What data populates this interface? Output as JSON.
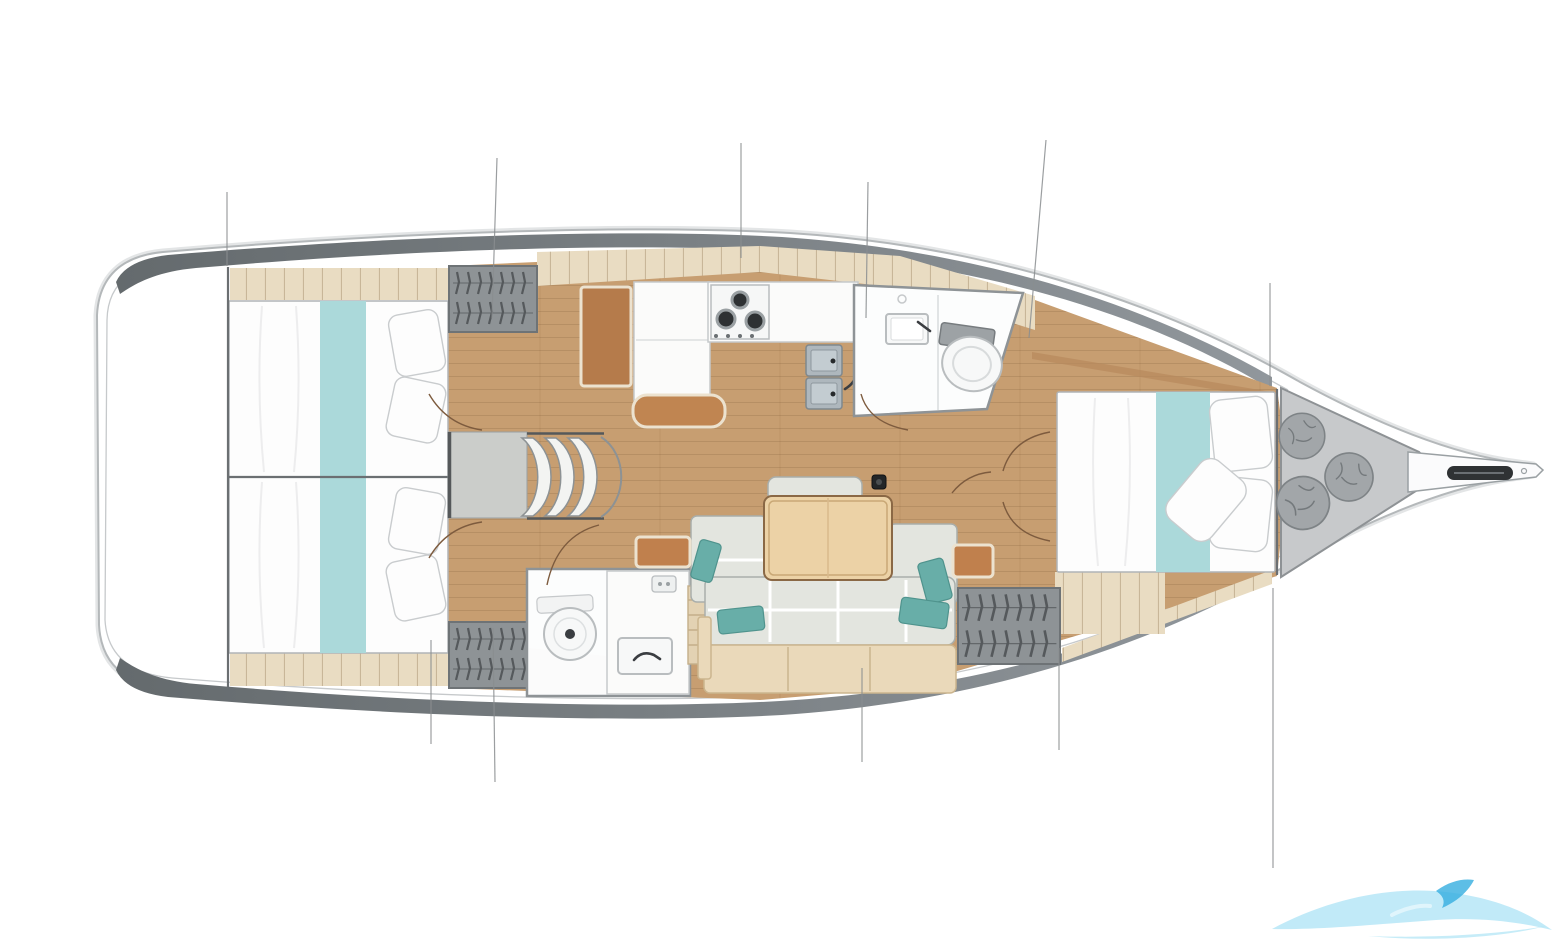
{
  "page": {
    "background": "#ffffff",
    "kind": "sailboat-deck-plan"
  },
  "colors": {
    "hull_fill": "#ffffff",
    "hull_outline": "#b4b8ba",
    "hull_outer_glow": "#e3e5e6",
    "sheer_line": "#c6c9cb",
    "bulwark_dark": "#646a6d",
    "bulwark_light": "#91979c",
    "floor_wood": "#c79e71",
    "deck_plank": "#e9dcc2",
    "plank_seam": "rgba(150,125,90,0.45)",
    "mattress": "#fdfdfd",
    "bed_outline": "#b0b4b7",
    "runner_teal": "#abd9da",
    "pillow_outline": "#c9ccce",
    "wardrobe_fill": "#8e9396",
    "wardrobe_border": "#6e7376",
    "hanger_dark": "#55595c",
    "step_fill": "#f3f4f2",
    "step_outline": "#8d9294",
    "platform_fill": "#cbcdca",
    "platform_edge": "#55585a",
    "counter_white": "#fbfbfa",
    "counter_outline": "#c6c9cb",
    "desk_brown": "#b57b4b",
    "bench_brown": "#c08551",
    "trim_cream": "#ece2cf",
    "burner_dark": "#2e3133",
    "sink_steel": "#aeb7bd",
    "sink_outline": "#7f888e",
    "faucet_dark": "#3a3d41",
    "head_outline": "#8e9396",
    "porcelain": "#f7f8f8",
    "porcelain_outline": "#b9bdbf",
    "tank_gray": "#9da2a5",
    "settee_fill": "#e3e5df",
    "settee_outline": "#a9aeab",
    "seam_white": "#ffffff",
    "pillow_teal": "#68aea8",
    "pillow_teal_dark": "#4f938d",
    "table_wood": "#ecd2a6",
    "table_outline": "#8a6845",
    "table_inner": "#c9a876",
    "base_wood": "#ead9ba",
    "base_outline": "#cbb58e",
    "shelf_brown": "#c0804d",
    "speaker_dark": "#232628",
    "forepeak_fill": "#c7c9cb",
    "forepeak_outline": "#8e9295",
    "bag_fill": "#a2a6a9",
    "bag_outline": "#7e8386",
    "bag_crinkle": "#74797c",
    "anchor_dark": "#2f3234",
    "bulkhead": "#6b6f72",
    "station_line": "#8a8e90",
    "door_arc": "#7d5b3e",
    "ladder_wood": "#e3d2b3",
    "ladder_edge": "#c4ae89",
    "watermark_light": "#8ed9f2",
    "watermark_dark": "#35aee0"
  },
  "watermark": {
    "present": true,
    "position": "bottom-right",
    "shape": "wave-swoosh"
  }
}
